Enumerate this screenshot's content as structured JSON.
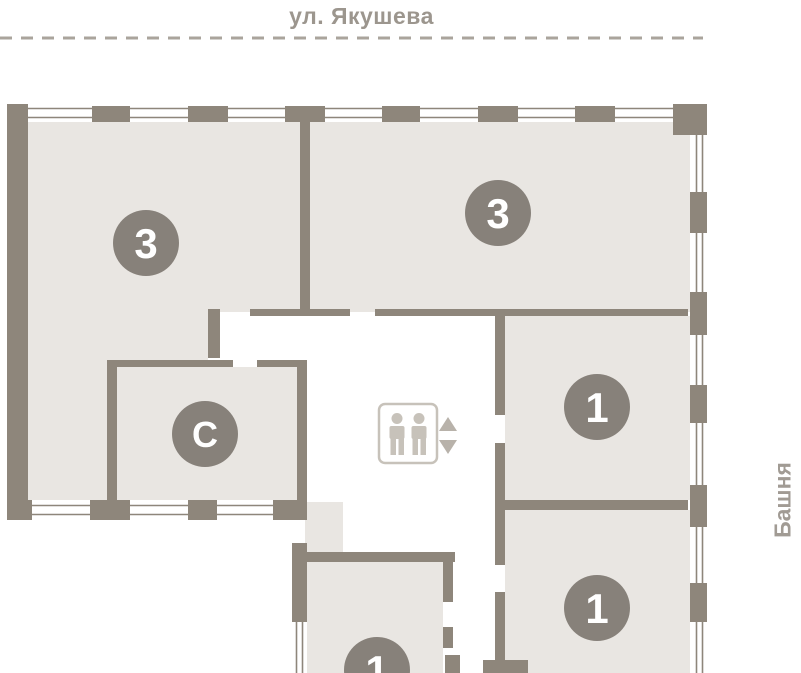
{
  "street": {
    "label": "ул. Якушева"
  },
  "tower": {
    "label": "Башня"
  },
  "rooms": [
    {
      "id": "3-left",
      "label": "3"
    },
    {
      "id": "3-right",
      "label": "3"
    },
    {
      "id": "studio",
      "label": "С"
    },
    {
      "id": "1-right-middle",
      "label": "1"
    },
    {
      "id": "1-right-bottom",
      "label": "1"
    },
    {
      "id": "1-bottom",
      "label": "1"
    }
  ],
  "icons": {
    "elevator": "elevator-people-icon",
    "up": "arrow-up-icon",
    "down": "arrow-down-icon"
  },
  "colors": {
    "wall": "#8e867b",
    "fill": "#e9e6e2",
    "badge": "#87817a",
    "badge_text": "#ffffff",
    "street_text": "#9c968e",
    "dash": "#aaa49c",
    "tower_text": "#a19b94",
    "lift": "#c7c2ba",
    "arrow": "#b8b2aa",
    "window": "#8e867b",
    "bg": "#ffffff"
  }
}
